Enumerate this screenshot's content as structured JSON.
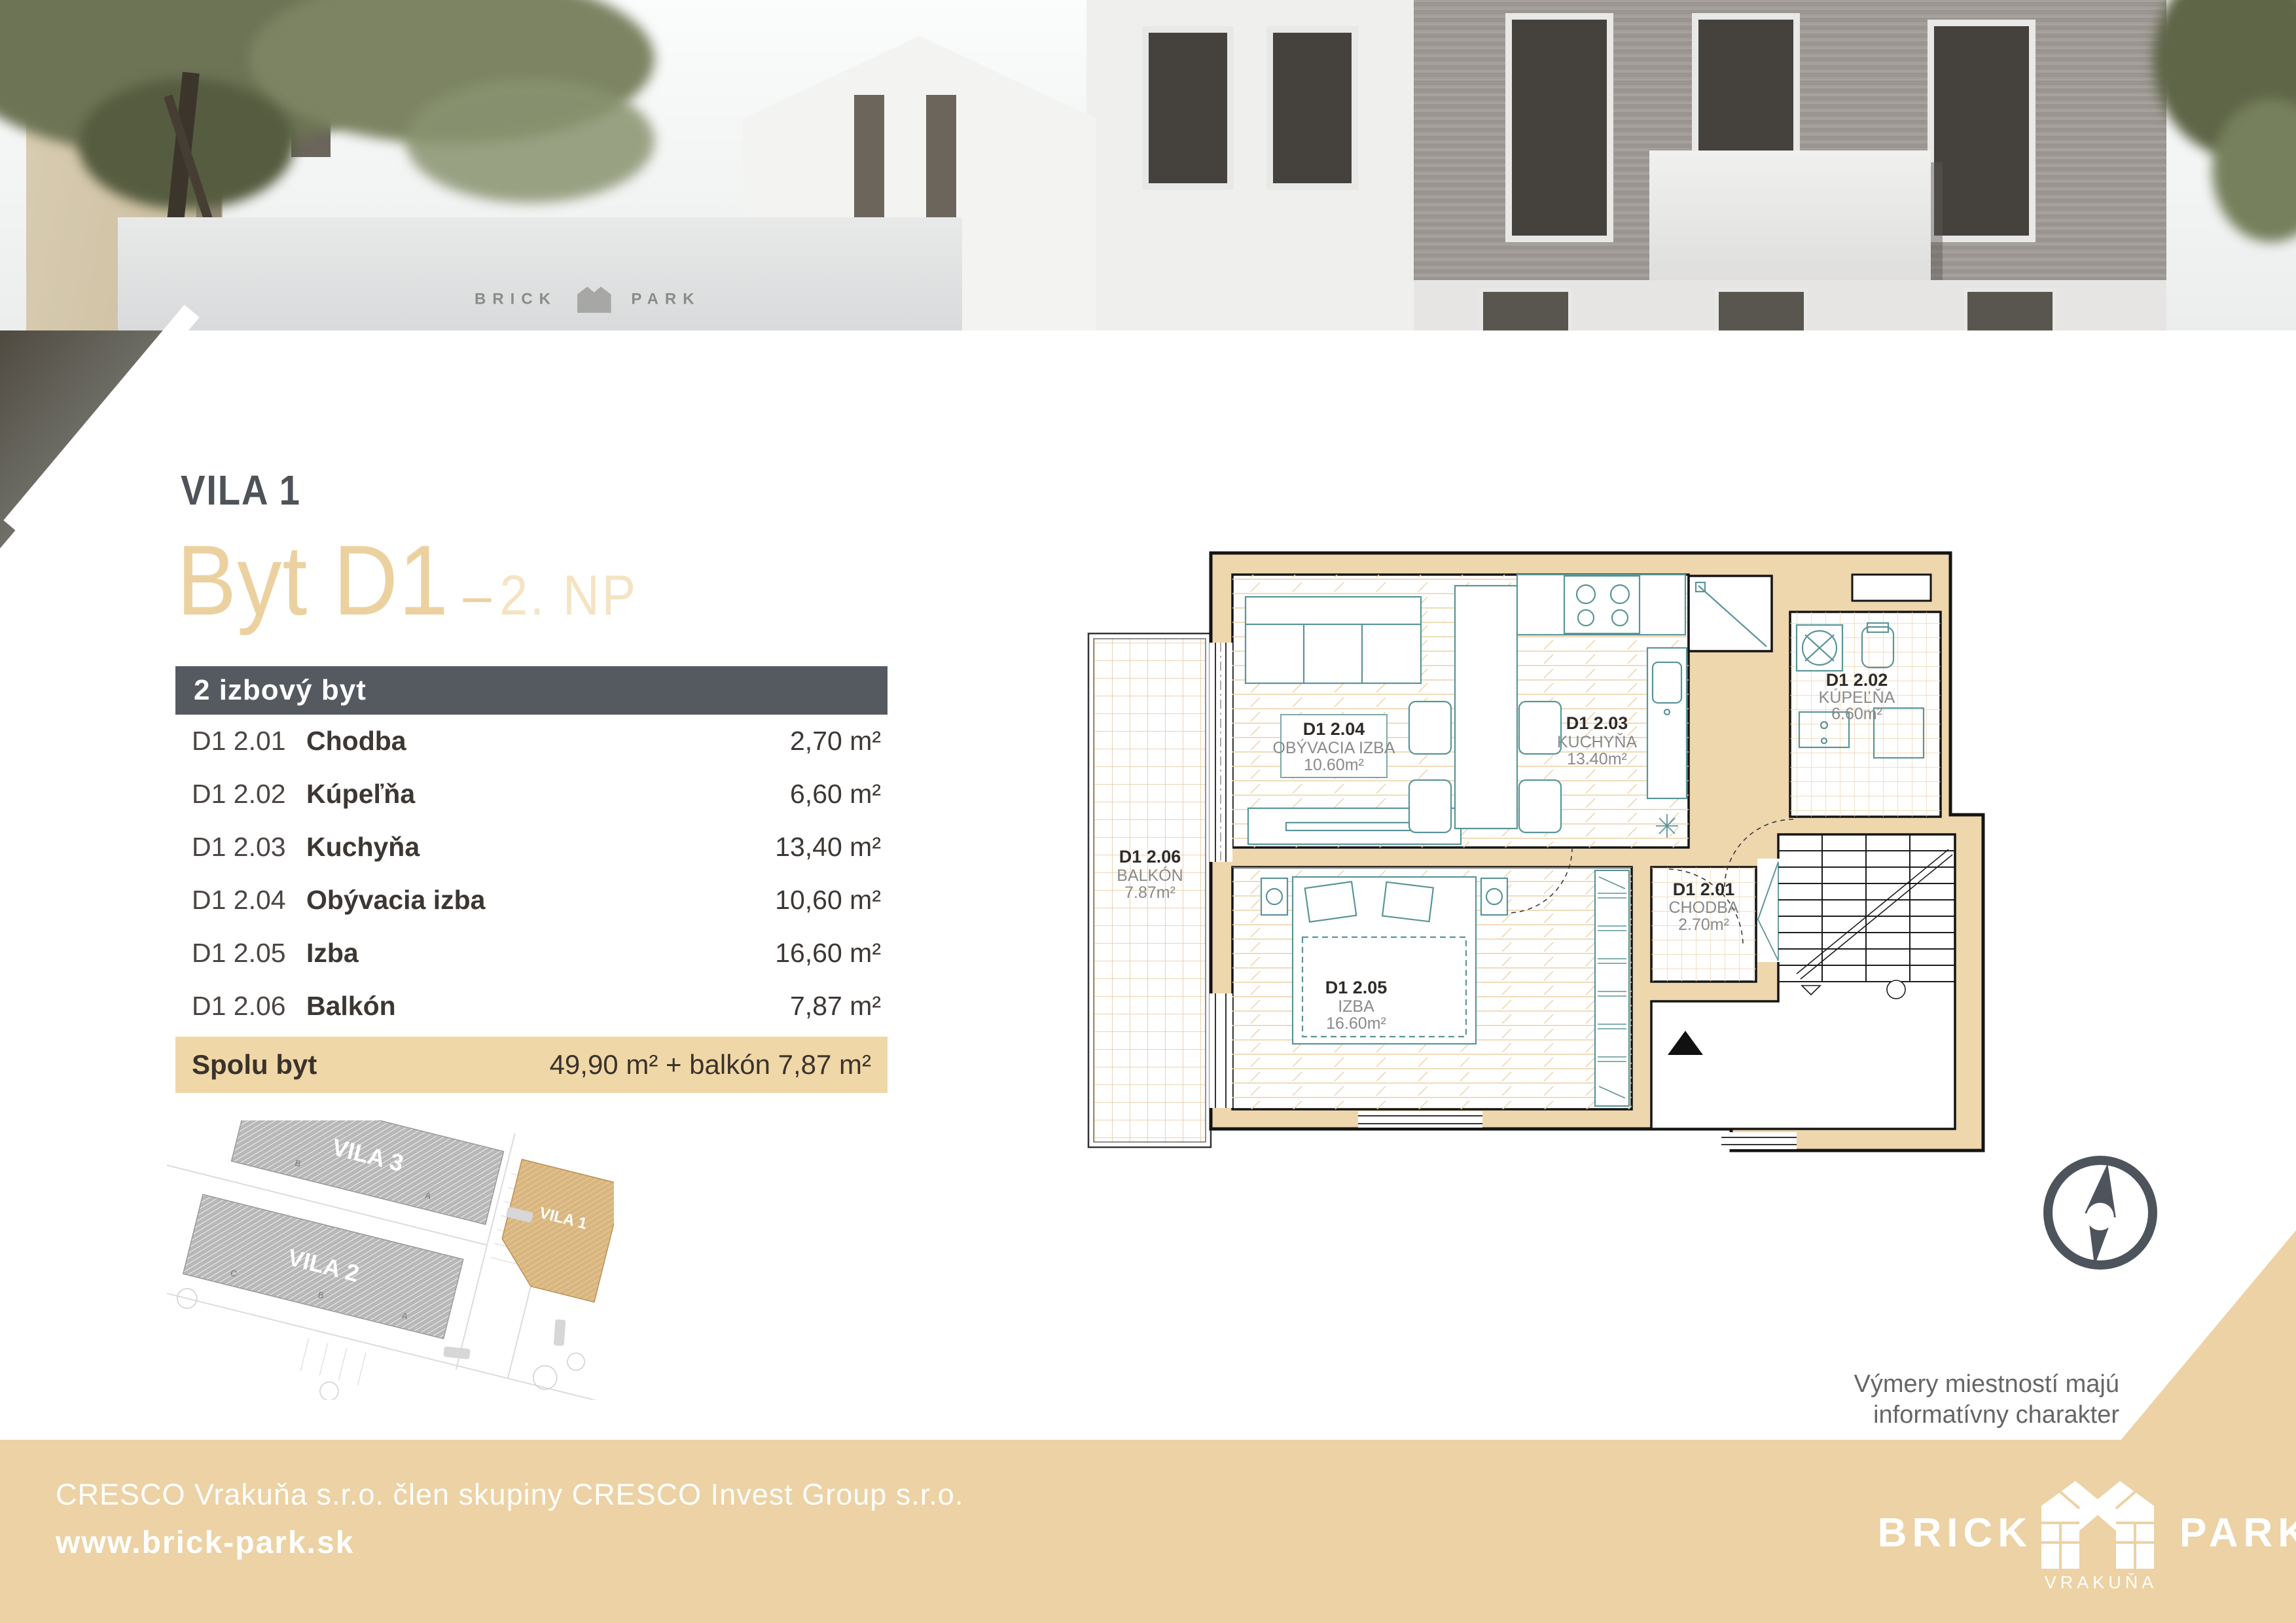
{
  "header": {
    "project": "VILA 1",
    "unit": "Byt D1",
    "dash": "–",
    "floor": "2. NP"
  },
  "photo": {
    "sign_left": "BRICK",
    "sign_right": "PARK"
  },
  "table": {
    "header": "2 izbový byt",
    "rows": [
      {
        "code": "D1 2.01",
        "name": "Chodba",
        "area": "2,70 m²"
      },
      {
        "code": "D1 2.02",
        "name": "Kúpeľňa",
        "area": "6,60 m²"
      },
      {
        "code": "D1 2.03",
        "name": "Kuchyňa",
        "area": "13,40 m²"
      },
      {
        "code": "D1 2.04",
        "name": "Obývacia izba",
        "area": "10,60 m²"
      },
      {
        "code": "D1 2.05",
        "name": "Izba",
        "area": "16,60 m²"
      },
      {
        "code": "D1 2.06",
        "name": "Balkón",
        "area": "7,87 m²"
      }
    ],
    "summary_label": "Spolu byt",
    "summary_value": "49,90 m² + balkón 7,87 m²"
  },
  "site_map": {
    "vila1": "VILA 1",
    "vila2": "VILA 2",
    "vila3": "VILA 3",
    "vila3_units": [
      "B",
      "A"
    ],
    "vila2_units": [
      "C",
      "B",
      "A"
    ]
  },
  "plan": {
    "rooms": [
      {
        "code": "D1 2.01",
        "name": "CHODBA",
        "area": "2.70m²"
      },
      {
        "code": "D1 2.02",
        "name": "KÚPEĽŇA",
        "area": "6.60m²"
      },
      {
        "code": "D1 2.03",
        "name": "KUCHYŇA",
        "area": "13.40m²"
      },
      {
        "code": "D1 2.04",
        "name": "OBÝVACIA IZBA",
        "area": "10.60m²"
      },
      {
        "code": "D1 2.05",
        "name": "IZBA",
        "area": "16.60m²"
      },
      {
        "code": "D1 2.06",
        "name": "BALKÓN",
        "area": "7.87m²"
      }
    ]
  },
  "disclaimer": {
    "line1": "Výmery miestností majú",
    "line2": "informatívny charakter"
  },
  "footer": {
    "line1": "CRESCO Vrakuňa s.r.o. člen skupiny CRESCO Invest Group s.r.o.",
    "line2": "www.brick-park.sk",
    "logo_left": "BRICK",
    "logo_right": "PARK",
    "logo_sub": "VRAKUŇA"
  },
  "colors": {
    "accent_beige": "#ecd2a4",
    "wall_beige": "#eed6ad",
    "header_gray": "#555a61",
    "title_gray": "#4d5359",
    "teal_furniture": "#5a9598"
  }
}
